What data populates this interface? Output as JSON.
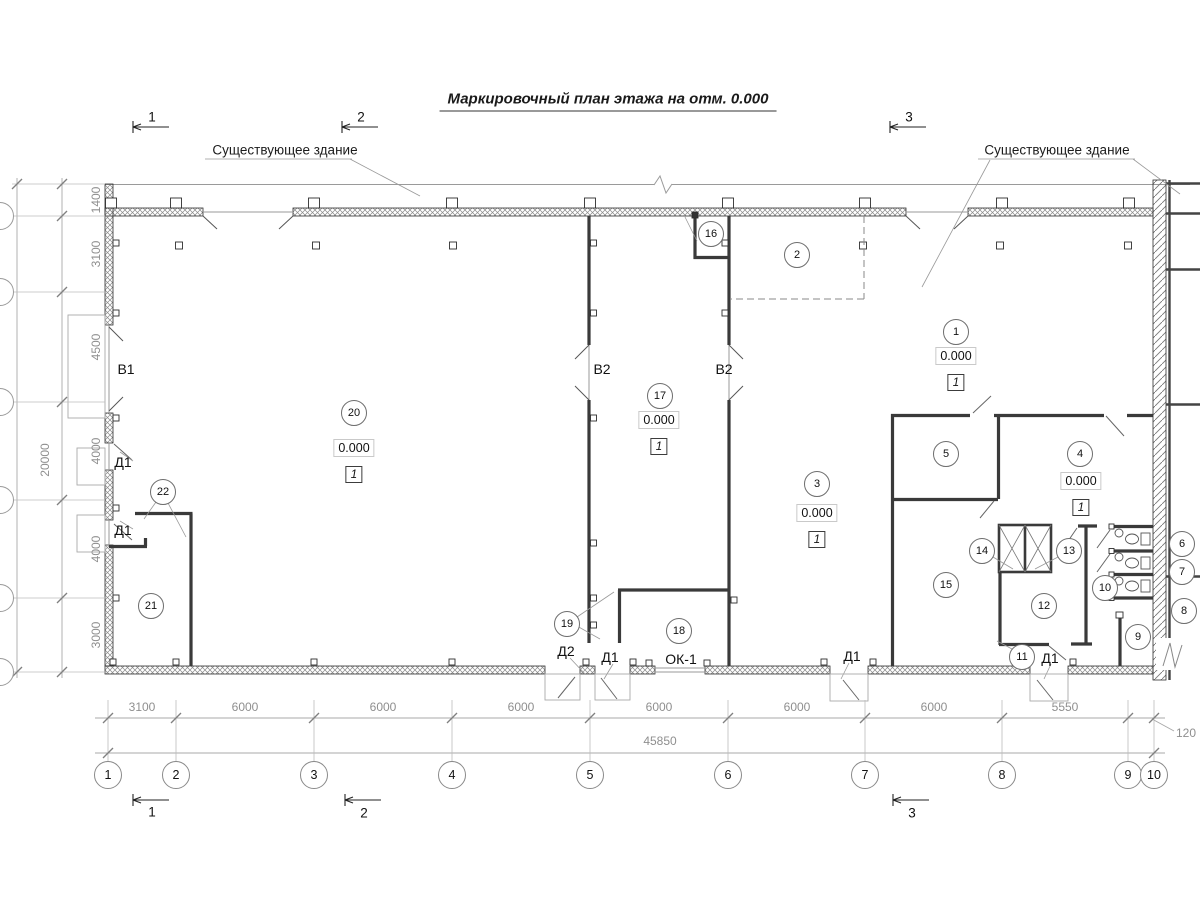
{
  "title": "Маркировочный план этажа на отм. 0.000",
  "annotations": {
    "existing_left": "Существующее здание",
    "existing_right": "Существующее здание"
  },
  "section_marks_top": [
    {
      "label": "1",
      "x": 152,
      "y": 117
    },
    {
      "label": "2",
      "x": 361,
      "y": 117
    },
    {
      "label": "3",
      "x": 909,
      "y": 117
    }
  ],
  "section_marks_bottom": [
    {
      "label": "1",
      "x": 152,
      "y": 812
    },
    {
      "label": "2",
      "x": 364,
      "y": 813
    },
    {
      "label": "3",
      "x": 912,
      "y": 813
    }
  ],
  "rooms": [
    {
      "number": "1",
      "x": 956,
      "y": 332
    },
    {
      "number": "2",
      "x": 797,
      "y": 255
    },
    {
      "number": "3",
      "x": 817,
      "y": 484
    },
    {
      "number": "4",
      "x": 1080,
      "y": 454
    },
    {
      "number": "5",
      "x": 946,
      "y": 454
    },
    {
      "number": "6",
      "x": 1182,
      "y": 544
    },
    {
      "number": "7",
      "x": 1182,
      "y": 572
    },
    {
      "number": "8",
      "x": 1184,
      "y": 611
    },
    {
      "number": "9",
      "x": 1138,
      "y": 637
    },
    {
      "number": "10",
      "x": 1105,
      "y": 588
    },
    {
      "number": "11",
      "x": 1022,
      "y": 657
    },
    {
      "number": "12",
      "x": 1044,
      "y": 606
    },
    {
      "number": "13",
      "x": 1069,
      "y": 551
    },
    {
      "number": "14",
      "x": 982,
      "y": 551
    },
    {
      "number": "15",
      "x": 946,
      "y": 585
    },
    {
      "number": "16",
      "x": 711,
      "y": 234
    },
    {
      "number": "17",
      "x": 660,
      "y": 396
    },
    {
      "number": "18",
      "x": 679,
      "y": 631
    },
    {
      "number": "19",
      "x": 567,
      "y": 624
    },
    {
      "number": "20",
      "x": 354,
      "y": 413
    },
    {
      "number": "21",
      "x": 151,
      "y": 606
    },
    {
      "number": "22",
      "x": 163,
      "y": 492
    }
  ],
  "elevations": [
    {
      "value": "0.000",
      "floor": "1",
      "x": 354,
      "y": 449
    },
    {
      "value": "0.000",
      "floor": "1",
      "x": 659,
      "y": 421
    },
    {
      "value": "0.000",
      "floor": "1",
      "x": 956,
      "y": 357
    },
    {
      "value": "0.000",
      "floor": "1",
      "x": 817,
      "y": 514
    },
    {
      "value": "0.000",
      "floor": "1",
      "x": 1081,
      "y": 482
    }
  ],
  "opening_labels": [
    {
      "label": "В1",
      "x": 126,
      "y": 369
    },
    {
      "label": "В2",
      "x": 602,
      "y": 369
    },
    {
      "label": "В2",
      "x": 724,
      "y": 369
    },
    {
      "label": "Д1",
      "x": 123,
      "y": 462
    },
    {
      "label": "Д1",
      "x": 123,
      "y": 530
    },
    {
      "label": "Д2",
      "x": 566,
      "y": 651
    },
    {
      "label": "Д1",
      "x": 610,
      "y": 657
    },
    {
      "label": "ОК-1",
      "x": 681,
      "y": 659
    },
    {
      "label": "Д1",
      "x": 852,
      "y": 656
    },
    {
      "label": "Д1",
      "x": 1050,
      "y": 658
    }
  ],
  "dims_bottom": {
    "segments": [
      {
        "label": "3100",
        "x": 142,
        "y": 707
      },
      {
        "label": "6000",
        "x": 245,
        "y": 707
      },
      {
        "label": "6000",
        "x": 383,
        "y": 707
      },
      {
        "label": "6000",
        "x": 521,
        "y": 707
      },
      {
        "label": "6000",
        "x": 659,
        "y": 707
      },
      {
        "label": "6000",
        "x": 797,
        "y": 707
      },
      {
        "label": "6000",
        "x": 934,
        "y": 707
      },
      {
        "label": "5550",
        "x": 1065,
        "y": 707
      }
    ],
    "extra": {
      "label": "120",
      "x": 1186,
      "y": 733
    },
    "total": {
      "label": "45850",
      "x": 660,
      "y": 741
    }
  },
  "axes_bottom": [
    {
      "label": "1",
      "x": 108,
      "y": 775
    },
    {
      "label": "2",
      "x": 176,
      "y": 775
    },
    {
      "label": "3",
      "x": 314,
      "y": 775
    },
    {
      "label": "4",
      "x": 452,
      "y": 775
    },
    {
      "label": "5",
      "x": 590,
      "y": 775
    },
    {
      "label": "6",
      "x": 728,
      "y": 775
    },
    {
      "label": "7",
      "x": 865,
      "y": 775
    },
    {
      "label": "8",
      "x": 1002,
      "y": 775
    },
    {
      "label": "9",
      "x": 1128,
      "y": 775
    },
    {
      "label": "10",
      "x": 1154,
      "y": 775
    }
  ],
  "dims_left": {
    "segments": [
      {
        "label": "1400",
        "x": 96,
        "y": 200
      },
      {
        "label": "3100",
        "x": 96,
        "y": 254
      },
      {
        "label": "4500",
        "x": 96,
        "y": 347
      },
      {
        "label": "4000",
        "x": 96,
        "y": 451
      },
      {
        "label": "4000",
        "x": 96,
        "y": 549
      },
      {
        "label": "3000",
        "x": 96,
        "y": 635
      }
    ],
    "total": {
      "label": "20000",
      "x": 45,
      "y": 460
    }
  },
  "axes_left": [
    {
      "label": "",
      "x": 0,
      "y": 216
    },
    {
      "label": "",
      "x": 0,
      "y": 292
    },
    {
      "label": "",
      "x": 0,
      "y": 402
    },
    {
      "label": "",
      "x": 0,
      "y": 500
    },
    {
      "label": "",
      "x": 0,
      "y": 598
    },
    {
      "label": "",
      "x": 0,
      "y": 672
    }
  ],
  "colors": {
    "wall_stroke": "#2e2e2e",
    "partition": "#3a3a3a",
    "dim_text": "#8f8f8f",
    "thin_line": "#9a9a9a"
  }
}
